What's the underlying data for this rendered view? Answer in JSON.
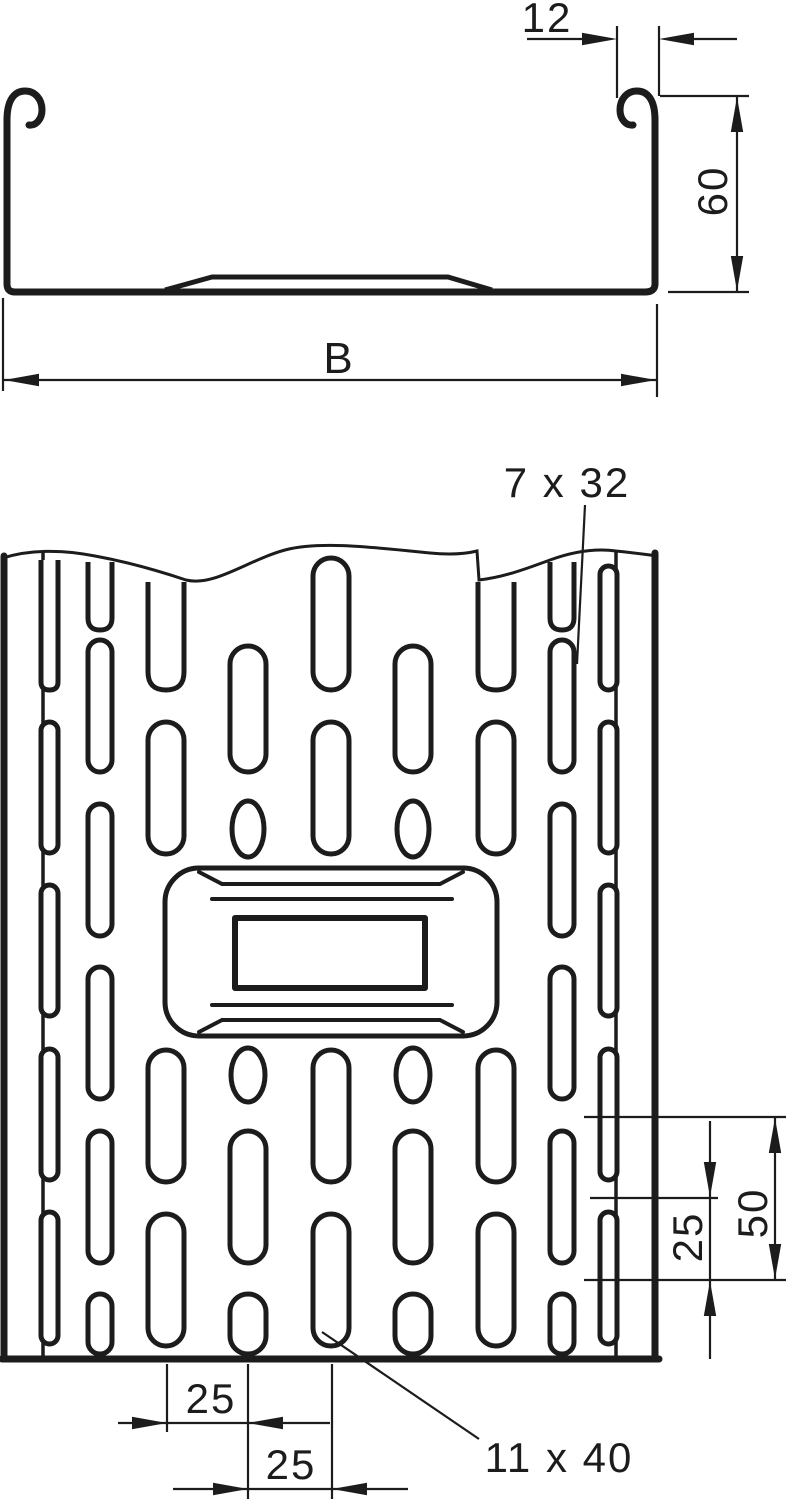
{
  "colors": {
    "background": "#ffffff",
    "line": "#1c1c1c"
  },
  "cross_section_view": {
    "flange_width": "12",
    "side_height": "60",
    "overall_width": "B"
  },
  "plan_view": {
    "side_slot_size": "7 x 32",
    "base_slot_size": "11 x 40",
    "pitch_row_small": "25",
    "pitch_row_large": "50",
    "pitch_col_1": "25",
    "pitch_col_2": "25"
  }
}
